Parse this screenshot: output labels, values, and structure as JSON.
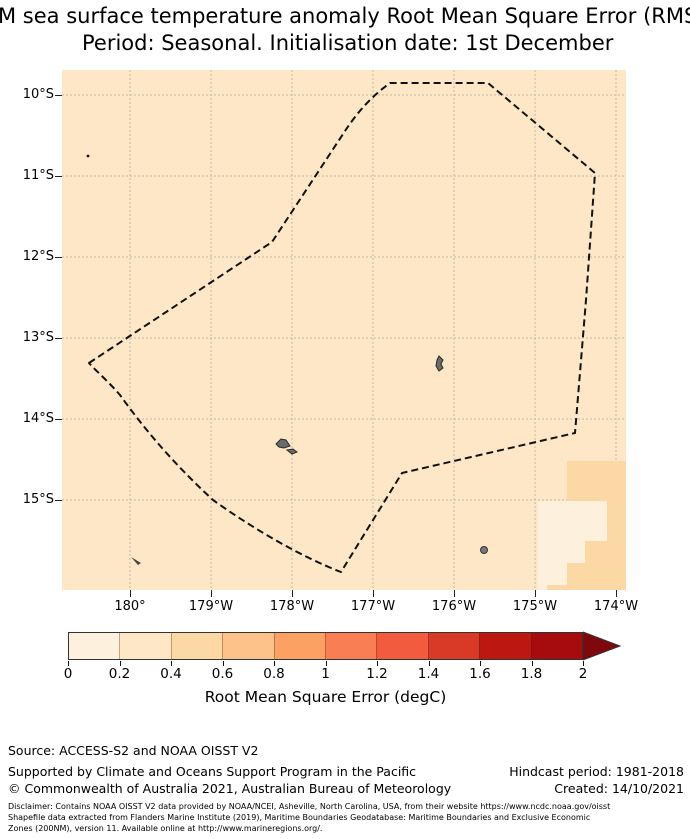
{
  "title": {
    "line1": "M sea surface temperature anomaly Root Mean Square Error (RMSE)",
    "line2": "Period: Seasonal. Initialisation date: 1st December"
  },
  "map": {
    "y_tick_labels": [
      "10°S",
      "11°S",
      "12°S",
      "13°S",
      "14°S",
      "15°S"
    ],
    "x_tick_labels": [
      "180°",
      "179°W",
      "178°W",
      "177°W",
      "176°W",
      "175°W",
      "174°W"
    ]
  },
  "colorbar": {
    "label": "Root Mean Square Error (degC)",
    "tick_labels": [
      "0",
      "0.2",
      "0.4",
      "0.6",
      "0.8",
      "1",
      "1.2",
      "1.4",
      "1.6",
      "1.8",
      "2"
    ],
    "bin_colors": [
      "#fdf1dd",
      "#fde7c6",
      "#fcd8a4",
      "#fcc28a",
      "#fba163",
      "#f97e53",
      "#f25b3d",
      "#d93a28",
      "#bd1712",
      "#a60c0e"
    ],
    "arrow_color": "#7e080b",
    "extend": "max"
  },
  "footer": {
    "source": "Source: ACCESS-S2 and NOAA OISST V2",
    "supported": "Supported by Climate and Oceans Support Program in the Pacific",
    "copyright": "© Commonwealth of Australia 2021, Australian Bureau of Meteorology",
    "hindcast": "Hindcast period: 1981-2018",
    "created": "Created: 14/10/2021",
    "disclaimer_line1": "Disclaimer: Contains NOAA OISST V2 data provided by NOAA/NCEI, Asheville, North Carolina, USA, from their website https://www.ncdc.noaa.gov/oisst",
    "disclaimer_line2": "Shapefile data extracted from Flanders Marine Institute (2019), Maritime Boundaries Geodatabase: Maritime Boundaries and Exclusive Economic",
    "disclaimer_line3": "Zones (200NM), version 11. Available online at http://www.marineregions.org/."
  },
  "chart_data": {
    "type": "heatmap",
    "title": "M sea surface temperature anomaly Root Mean Square Error (RMSE)",
    "subtitle": "Period: Seasonal. Initialisation date: 1st December",
    "x_ticks": [
      "180°",
      "179°W",
      "178°W",
      "177°W",
      "176°W",
      "175°W",
      "174°W"
    ],
    "y_ticks": [
      "10°S",
      "11°S",
      "12°S",
      "13°S",
      "14°S",
      "15°S"
    ],
    "grid": true,
    "colorbar": {
      "label": "Root Mean Square Error (degC)",
      "min": 0,
      "max": 2,
      "step": 0.2,
      "extend": "max",
      "orientation": "horizontal"
    },
    "regions": [
      {
        "area": "entire mapped ocean including EEZ polygon",
        "rmse_degC": "0.2-0.4"
      },
      {
        "area": "patch south of 15°S between about 175.1°W and 174.2°W",
        "rmse_degC": "0-0.2"
      },
      {
        "area": "south-east corner staircase near 174°W, roughly 14.5°S-16°S",
        "rmse_degC": "0.4-0.6"
      }
    ],
    "overlays": [
      "dashed EEZ / 200NM boundary polygon spanning about 9.9°S-15.9°S and 179.5°E-174.2°W",
      "small grey island landmasses near 13.3°S 176.2°W, 14.3°S 178.1°W, 15.6°S 175.6°W, 15.7°S 179.9°W, 10.8°S 179.5°E"
    ]
  }
}
